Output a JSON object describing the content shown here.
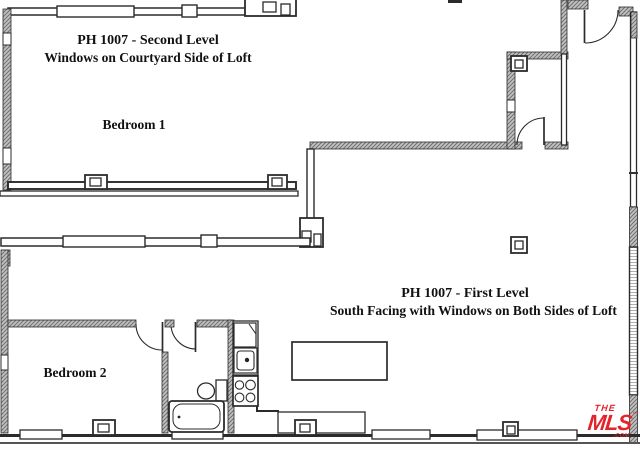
{
  "page": {
    "background": "#ffffff",
    "line_color": "#2b2b2b",
    "hatch_fill": "#c2c2c2",
    "hatch_stroke": "#6f6f6f"
  },
  "second_level": {
    "title": "PH 1007 - Second Level",
    "subtitle": "Windows on Courtyard Side of Loft",
    "room_label": "Bedroom 1"
  },
  "first_level": {
    "title": "PH 1007 - First Level",
    "subtitle": "South Facing with Windows on Both Sides of Loft",
    "room_label": "Bedroom 2"
  },
  "logo": {
    "the": "THE",
    "mls": "MLS",
    "tm": "™",
    "com": ".COM",
    "color": "#e2242b"
  },
  "icons": [
    "bathtub-icon",
    "toilet-icon",
    "kitchen-sink-icon",
    "stove-icon",
    "refrigerator-icon",
    "kitchen-island-icon",
    "column-icon",
    "door-swing-icon",
    "window-icon"
  ]
}
